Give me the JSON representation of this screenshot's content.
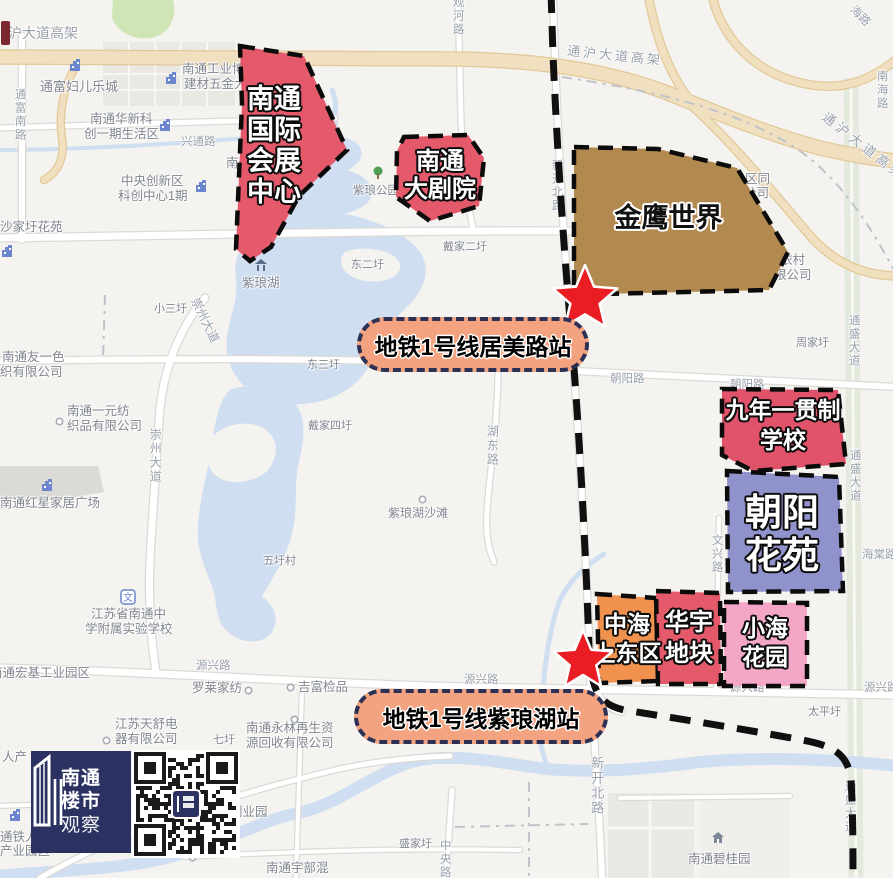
{
  "map": {
    "width": 893,
    "height": 878,
    "colors": {
      "bg": "#f4f3f0",
      "water": "#cfdff1",
      "road_fill": "#ffffff",
      "road_casing": "#dcdad5",
      "highway_fill": "#f0e0bf",
      "highway_casing": "#e2c997",
      "green": "#cfe5b6",
      "green_road": "#e4e9de",
      "building": "#eae8e3",
      "building_dark": "#dbdad6",
      "boundary": "#bfc3c9",
      "metro_line": "#101010",
      "star_red": "#ea1c24",
      "pill_bg": "#f3a37f",
      "pill_border": "#2b3054",
      "poi_label": "#80858f",
      "road_label": "#98a0ab",
      "icon_blue": "#6b86cf",
      "logo_bg": "#2b3262",
      "site_red": "#e55a6b",
      "site_orange": "#f0924e",
      "site_pink": "#f3a6c5",
      "site_periwinkle": "#9093cb",
      "site_brown": "#b2894f"
    },
    "stations": [
      {
        "label": "地铁1号线居美路站",
        "pill": {
          "x": 357,
          "y": 317,
          "w": 224,
          "h": 47,
          "fs": 23
        },
        "star": {
          "cx": 585,
          "cy": 299,
          "r": 34
        }
      },
      {
        "label": "地铁1号线紫琅湖站",
        "pill": {
          "x": 354,
          "y": 689,
          "w": 246,
          "h": 47,
          "fs": 23
        },
        "star": {
          "cx": 583,
          "cy": 661,
          "r": 31
        }
      }
    ],
    "sites": [
      {
        "id": "convention-center",
        "lines": [
          "南通",
          "国际",
          "会展",
          "中心"
        ],
        "fill": "#e55a6b",
        "style": "light",
        "points": "240,46 304,56 347,150 299,196 271,247 250,261 236,249 242,104",
        "label": {
          "x": 234,
          "y": 84,
          "w": 80,
          "size": 27,
          "lh": 1.15
        }
      },
      {
        "id": "grand-theatre",
        "lines": [
          "南通",
          "大剧院"
        ],
        "fill": "#e55a6b",
        "style": "light",
        "points": "404,137 468,135 484,158 479,206 430,221 396,197 397,151",
        "label": {
          "x": 392,
          "y": 148,
          "w": 96,
          "size": 24,
          "lh": 1.15
        }
      },
      {
        "id": "golden-eagle-world",
        "lines": [
          "金鹰世界"
        ],
        "fill": "#b2894f",
        "style": "dark",
        "points": "574,147 658,149 737,168 788,252 769,290 601,294 574,287",
        "label": {
          "x": 596,
          "y": 204,
          "w": 145,
          "size": 27,
          "lh": 1.1
        }
      },
      {
        "id": "nine-year-school",
        "lines": [
          "九年一贯制",
          "学校"
        ],
        "fill": "#e0536a",
        "style": "light",
        "points": "722,389 838,390 846,464 753,471 722,455",
        "label": {
          "x": 720,
          "y": 396,
          "w": 126,
          "size": 23,
          "lh": 1.3
        }
      },
      {
        "id": "chaoyang-garden",
        "lines": [
          "朝阳",
          "花苑"
        ],
        "fill": "#9093cb",
        "style": "light",
        "points": "727,471 839,477 843,591 728,592",
        "label": {
          "x": 730,
          "y": 492,
          "w": 104,
          "size": 37,
          "lh": 1.15
        }
      },
      {
        "id": "zhonghai-east-plot",
        "lines": [
          "中海",
          "上东区"
        ],
        "fill": "#f0924e",
        "style": "light",
        "points": "597,594 656,598 658,681 599,683",
        "label": {
          "x": 586,
          "y": 610,
          "w": 82,
          "size": 23,
          "lh": 1.28
        }
      },
      {
        "id": "huayu-plot",
        "lines": [
          "华宇",
          "地块"
        ],
        "fill": "#e55a6b",
        "style": "light",
        "points": "656,591 720,593 721,684 658,684",
        "label": {
          "x": 656,
          "y": 608,
          "w": 66,
          "size": 24,
          "lh": 1.28
        }
      },
      {
        "id": "xiaohai-garden",
        "lines": [
          "小海",
          "花园"
        ],
        "fill": "#f3a6c5",
        "style": "light",
        "points": "724,602 807,603 807,686 724,686",
        "label": {
          "x": 722,
          "y": 614,
          "w": 86,
          "size": 23,
          "lh": 1.28
        }
      }
    ],
    "base_labels": [
      {
        "t": "沪大道高架",
        "x": 8,
        "y": 26,
        "s": 14,
        "c": "road"
      },
      {
        "t": "通沪大道高架",
        "x": 568,
        "y": 44,
        "s": 13,
        "c": "road",
        "rot": 6,
        "ls": 3
      },
      {
        "t": "通沪大道高架",
        "x": 828,
        "y": 110,
        "s": 13,
        "c": "road",
        "rot": 38,
        "ls": 4
      },
      {
        "t": "通富妇儿乐城",
        "x": 40,
        "y": 80,
        "s": 13,
        "c": "poi"
      },
      {
        "t": "南通工业博",
        "x": 182,
        "y": 63,
        "s": 12.5,
        "c": "poi"
      },
      {
        "t": "建材五金大",
        "x": 184,
        "y": 78,
        "s": 12.5,
        "c": "poi"
      },
      {
        "t": "南通华新科",
        "x": 90,
        "y": 113,
        "s": 12.5,
        "c": "poi"
      },
      {
        "t": "创一期生活区",
        "x": 84,
        "y": 128,
        "s": 12.5,
        "c": "poi"
      },
      {
        "t": "兴通路",
        "x": 181,
        "y": 136,
        "s": 11.5,
        "c": "road"
      },
      {
        "t": "中央创新区",
        "x": 121,
        "y": 175,
        "s": 12.5,
        "c": "poi"
      },
      {
        "t": "科创中心1期",
        "x": 118,
        "y": 190,
        "s": 12.5,
        "c": "poi"
      },
      {
        "t": "沙家圩花苑",
        "x": 0,
        "y": 221,
        "s": 12.5,
        "c": "poi"
      },
      {
        "t": "通富南路",
        "x": 13,
        "y": 88,
        "s": 11.5,
        "c": "road",
        "v": 1
      },
      {
        "t": "南通国际会展中心",
        "x": 226,
        "y": 157,
        "s": 12.5,
        "c": "poi"
      },
      {
        "t": "紫琅湖",
        "x": 242,
        "y": 277,
        "s": 12.5,
        "c": "poi"
      },
      {
        "t": "紫琅公园",
        "x": 353,
        "y": 185,
        "s": 11.5,
        "c": "poi"
      },
      {
        "t": "观河路",
        "x": 451,
        "y": -4,
        "s": 11.5,
        "c": "road",
        "v": 1
      },
      {
        "t": "东二圩",
        "x": 351,
        "y": 259,
        "s": 11,
        "c": "poi"
      },
      {
        "t": "戴家二圩",
        "x": 443,
        "y": 241,
        "s": 11,
        "c": "poi"
      },
      {
        "t": "新开北路",
        "x": 550,
        "y": 159,
        "s": 11.5,
        "c": "road",
        "v": 1
      },
      {
        "t": "小三圩",
        "x": 154,
        "y": 303,
        "s": 11,
        "c": "poi"
      },
      {
        "t": "崇州大道",
        "x": 200,
        "y": 296,
        "s": 12,
        "c": "road",
        "rot": 64
      },
      {
        "t": "崇州大道",
        "x": 148,
        "y": 428,
        "s": 12,
        "c": "road",
        "v": 1
      },
      {
        "t": "南通友一色",
        "x": 2,
        "y": 351,
        "s": 12.5,
        "c": "poi"
      },
      {
        "t": "织有限公司",
        "x": 0,
        "y": 366,
        "s": 12.5,
        "c": "poi"
      },
      {
        "t": "南通一元纺",
        "x": 67,
        "y": 405,
        "s": 12.5,
        "c": "poi"
      },
      {
        "t": "织品有限公司",
        "x": 67,
        "y": 420,
        "s": 12.5,
        "c": "poi"
      },
      {
        "t": "南通红星家居广场",
        "x": 0,
        "y": 497,
        "s": 12.5,
        "c": "poi"
      },
      {
        "t": "五圩村",
        "x": 263,
        "y": 555,
        "s": 11,
        "c": "poi"
      },
      {
        "t": "东三圩",
        "x": 307,
        "y": 359,
        "s": 11,
        "c": "poi"
      },
      {
        "t": "戴家四圩",
        "x": 308,
        "y": 420,
        "s": 11,
        "c": "poi"
      },
      {
        "t": "湖东路",
        "x": 485,
        "y": 425,
        "s": 12,
        "c": "road",
        "v": 1
      },
      {
        "t": "紫琅湖沙滩",
        "x": 388,
        "y": 507,
        "s": 12,
        "c": "poi"
      },
      {
        "t": "朝阳路",
        "x": 610,
        "y": 373,
        "s": 11.5,
        "c": "road"
      },
      {
        "t": "朝阳路",
        "x": 730,
        "y": 379,
        "s": 11.5,
        "c": "road"
      },
      {
        "t": "周家圩",
        "x": 796,
        "y": 337,
        "s": 11,
        "c": "poi"
      },
      {
        "t": "通盛大道",
        "x": 847,
        "y": 314,
        "s": 11.5,
        "c": "road",
        "v": 1
      },
      {
        "t": "通盛大道",
        "x": 848,
        "y": 449,
        "s": 11.5,
        "c": "road",
        "v": 1
      },
      {
        "t": "通盛大道",
        "x": 843,
        "y": 780,
        "s": 11.5,
        "c": "road",
        "v": 1
      },
      {
        "t": "文兴路",
        "x": 710,
        "y": 534,
        "s": 11.5,
        "c": "road",
        "v": 1
      },
      {
        "t": "海棠路",
        "x": 862,
        "y": 549,
        "s": 11.5,
        "c": "road"
      },
      {
        "t": "江苏省南通中",
        "x": 91,
        "y": 608,
        "s": 12.5,
        "c": "poi"
      },
      {
        "t": "学附属实验学校",
        "x": 85,
        "y": 623,
        "s": 12.5,
        "c": "poi"
      },
      {
        "t": "南通宏基工业园区",
        "x": -10,
        "y": 667,
        "s": 12.5,
        "c": "poi"
      },
      {
        "t": "源兴路",
        "x": 196,
        "y": 660,
        "s": 11.5,
        "c": "road"
      },
      {
        "t": "罗莱家纺",
        "x": 192,
        "y": 682,
        "s": 12.5,
        "c": "poi"
      },
      {
        "t": "江苏天舒电",
        "x": 115,
        "y": 718,
        "s": 12.5,
        "c": "poi"
      },
      {
        "t": "器有限公司",
        "x": 115,
        "y": 733,
        "s": 12.5,
        "c": "poi"
      },
      {
        "t": "七圩",
        "x": 213,
        "y": 734,
        "s": 11,
        "c": "poi"
      },
      {
        "t": "南通永林再生资",
        "x": 246,
        "y": 722,
        "s": 12.5,
        "c": "poi"
      },
      {
        "t": "源回收有限公司",
        "x": 246,
        "y": 737,
        "s": 12.5,
        "c": "poi"
      },
      {
        "t": "吉富检品",
        "x": 298,
        "y": 681,
        "s": 12.5,
        "c": "poi"
      },
      {
        "t": "源兴路",
        "x": 464,
        "y": 674,
        "s": 11.5,
        "c": "road"
      },
      {
        "t": "源兴路",
        "x": 730,
        "y": 682,
        "s": 11.5,
        "c": "road"
      },
      {
        "t": "源兴路",
        "x": 864,
        "y": 682,
        "s": 11.5,
        "c": "road"
      },
      {
        "t": "太平圩",
        "x": 808,
        "y": 706,
        "s": 11,
        "c": "poi"
      },
      {
        "t": "新开北路",
        "x": 589,
        "y": 756,
        "s": 13,
        "c": "road",
        "v": 1
      },
      {
        "t": "中央路",
        "x": 438,
        "y": 839,
        "s": 11.5,
        "c": "road",
        "v": 1
      },
      {
        "t": "盛家圩",
        "x": 399,
        "y": 838,
        "s": 11,
        "c": "poi"
      },
      {
        "t": "南通碧桂园",
        "x": 688,
        "y": 853,
        "s": 12.5,
        "c": "poi"
      },
      {
        "t": "南通宇部混",
        "x": 266,
        "y": 862,
        "s": 12.5,
        "c": "poi"
      },
      {
        "t": "创业园",
        "x": 230,
        "y": 806,
        "s": 12.5,
        "c": "poi"
      },
      {
        "t": "通铁人",
        "x": 0,
        "y": 831,
        "s": 12.5,
        "c": "poi"
      },
      {
        "t": "产业园区",
        "x": 0,
        "y": 845,
        "s": 12.5,
        "c": "poi"
      },
      {
        "t": "南海路",
        "x": 875,
        "y": 70,
        "s": 11.5,
        "c": "road",
        "v": 1
      },
      {
        "t": "海路",
        "x": 856,
        "y": 4,
        "s": 11.5,
        "c": "road",
        "rot": 45
      },
      {
        "t": "依村",
        "x": 780,
        "y": 254,
        "s": 12.5,
        "c": "poi"
      },
      {
        "t": "限公司",
        "x": 774,
        "y": 269,
        "s": 12.5,
        "c": "poi"
      },
      {
        "t": "区同",
        "x": 745,
        "y": 173,
        "s": 12.5,
        "c": "poi"
      },
      {
        "t": "公司",
        "x": 744,
        "y": 187,
        "s": 12.5,
        "c": "poi"
      },
      {
        "t": "人产",
        "x": 2,
        "y": 751,
        "s": 12.5,
        "c": "poi"
      }
    ],
    "markers": [
      {
        "k": "building",
        "x": 68,
        "y": 58
      },
      {
        "k": "building",
        "x": 164,
        "y": 71
      },
      {
        "k": "building",
        "x": 158,
        "y": 118
      },
      {
        "k": "building",
        "x": 194,
        "y": 179
      },
      {
        "k": "building",
        "x": 40,
        "y": 478
      },
      {
        "k": "building",
        "x": 8,
        "y": 808
      },
      {
        "k": "building",
        "x": 226,
        "y": 790
      },
      {
        "k": "building",
        "x": 0,
        "y": 244
      },
      {
        "k": "pavilion",
        "x": 254,
        "y": 258
      },
      {
        "k": "tree",
        "x": 372,
        "y": 166
      },
      {
        "k": "school",
        "x": 120,
        "y": 589
      },
      {
        "k": "house",
        "x": 710,
        "y": 830
      },
      {
        "k": "circle",
        "x": 55,
        "y": 417
      },
      {
        "k": "circle",
        "x": 418,
        "y": 495
      },
      {
        "k": "circle",
        "x": 244,
        "y": 686
      },
      {
        "k": "circle",
        "x": 286,
        "y": 683
      },
      {
        "k": "circle",
        "x": 290,
        "y": 715
      },
      {
        "k": "circle",
        "x": 102,
        "y": 736
      },
      {
        "k": "circle",
        "x": 188,
        "y": 853
      },
      {
        "k": "redbar",
        "x": 0,
        "y": 20
      }
    ],
    "logo": {
      "lines": [
        "南通",
        "楼市",
        "观察"
      ]
    }
  }
}
